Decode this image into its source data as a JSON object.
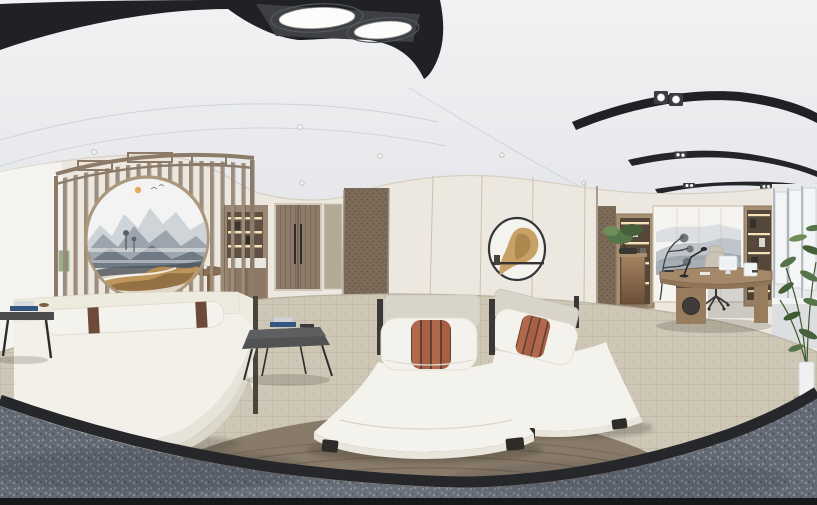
{
  "scene": {
    "description": "360-degree equirectangular interior panorama: Chinese-style spa massage room with moon-gate lattice screen, ink-wash circular painting, white daybed, two white massage loungers with rust-striped pillows, and an executive office corner with desk, lit shelving, mountain mural, windows and plants",
    "text_content": ""
  },
  "palette": {
    "ceiling_top": "#f1f2f3",
    "ceiling_bottom": "#e4e6e9",
    "black_band": "#202124",
    "light_panel": "#3e4043",
    "lamp_white": "#fcfcfa",
    "wall_cream": "#ece8df",
    "wall_left_white": "#f4f3ef",
    "trim_taupe": "#c6bcab",
    "accent_panel": "#7c6b59",
    "door_wood": "#8d7a68",
    "door_handle": "#2e2c29",
    "kitchen_wood": "#9b8674",
    "niche_dark": "#5e5144",
    "shelf_glow": "#f4e3b9",
    "counter_white": "#e9e7e1",
    "screen_wood": "#9c8c79",
    "screen_frame": "#8b7b68",
    "painting_bg": "#f2f3f2",
    "mountain_far": "#c9ced4",
    "mountain_mid": "#99a2ab",
    "mountain_near": "#6f7a85",
    "marble_gold": "#bb8f51",
    "marble_brown": "#8a6740",
    "marble_dark": "#4e555e",
    "sun_gold": "#e2a14c",
    "daybed_white": "#f2f0e9",
    "daybed_step": "#e6e3d9",
    "cushion_gray": "#d8d4ca",
    "bolster_band": "#6e4b38",
    "table_dark": "#4b4c4e",
    "leg_dark": "#2c2c2c",
    "book_blue": "#34557f",
    "book_white": "#cfd3d7",
    "bed_white": "#f4f2ec",
    "bed_frame": "#3b3937",
    "pillow_stripe": "#b2684a",
    "stripe_gap": "#5c4134",
    "art_rim": "#33373c",
    "art_face": "#f5f3ed",
    "art_tan": "#c7a166",
    "art_tan_dark": "#a8814a",
    "art_bar": "#3a3330",
    "mural_bg": "#f5f4f0",
    "mural_tree": "#3b3e41",
    "shelf_wood": "#a78f74",
    "shelf_dark": "#55483a",
    "bronze_dark": "#6b4f38",
    "desk_wood": "#a5886a",
    "desk_edge": "#6f5a44",
    "cabinet_wood": "#977c5e",
    "speaker_dark": "#3f3d3a",
    "monitor_white": "#f6f7f8",
    "chair_beige": "#cbc4b6",
    "window_wall": "#e8eaeb",
    "window_blind": "#f3f5f6",
    "window_frame": "#9aa0a5",
    "plant_green": "#55744a",
    "plant_dark": "#46603a",
    "pot_white": "#eff0f1",
    "carpet_beige": "#cec7b6",
    "rug_brown": "#897b69",
    "granite_gray": "#646b75",
    "ring_black": "#26272b",
    "bottom_strip": "#16181b"
  }
}
